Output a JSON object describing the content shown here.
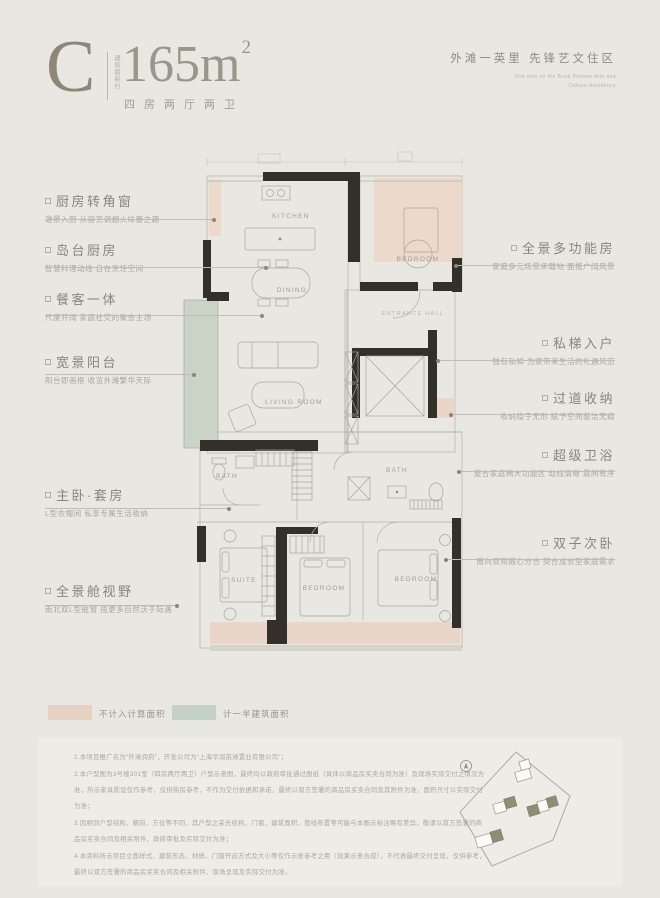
{
  "header": {
    "type_letter": "C",
    "area_label_vertical": "建筑面积约",
    "area_value": "165m",
    "area_sup": "2",
    "layout_text": "四房两厅两卫",
    "project_name": "外滩一英里  先锋艺文住区",
    "project_sub_en_1": "One mile on the Bund Pioneer Arts and",
    "project_sub_en_2": "Culture Residency"
  },
  "plan": {
    "rooms": {
      "kitchen": "KITCHEN",
      "dining": "DINING",
      "living": "LIVING ROOM",
      "bedroom_top": "BEDROOM",
      "entrance": "ENTRANCE HALL",
      "bath_left": "BATH",
      "bath_right": "BATH",
      "suite": "SUITE",
      "bedroom_mid": "BEDROOM",
      "bedroom_right": "BEDROOM"
    }
  },
  "callouts_left": [
    {
      "title": "厨房转角窗",
      "sub": "邀景入厨 从容烹调烟火味蕾之趣"
    },
    {
      "title": "岛台厨房",
      "sub": "智慧料理动线 自在烹饪空间"
    },
    {
      "title": "餐客一体",
      "sub": "尺度开阔 家庭社交的聚会主场"
    },
    {
      "title": "宽景阳台",
      "sub": "阳台即画框 收览外滩繁华天际"
    },
    {
      "title": "主卧·套房",
      "sub": "L型衣帽间 私享专属生活收纳"
    },
    {
      "title": "全景舱视野",
      "sub": "南北双L型舷窗 揽更多自然沃于际遇"
    }
  ],
  "callouts_right": [
    {
      "title": "全景多功能房",
      "sub": "家庭多元场景承载地 面揽广阔风景"
    },
    {
      "title": "私梯入户",
      "sub": "独有私梯 为家带来生活的礼遇风范"
    },
    {
      "title": "过道收纳",
      "sub": "收纳隐于无形 赋予空间整洁无痕"
    },
    {
      "title": "超级卫浴",
      "sub": "整合家庭两大功能区 动线清晰 晨间有序"
    },
    {
      "title": "双子次卧",
      "sub": "南向双阳随心分合 契合成长型家庭需求"
    }
  ],
  "legend": [
    {
      "label": "不计入计算面积",
      "color": "#e6d2c5"
    },
    {
      "label": "计一半建筑面积",
      "color": "#c6d1c5"
    }
  ],
  "disclaimer": {
    "items": [
      "1.本项目推广名为“外滩润府”，开发公司为“上海华润前滩置业有限公司”；",
      "2.本户型图为3号楼301室（四房两厅两卫）户型示意图，最终均以政府审批通过图纸（具体以商品房买卖合同为准）及现场实际交付之情况为准，所示家具陈设仅作参考，仅供购房参考，不作为交付依据和承诺，最终以双方签署的商品房买卖合同及其附件为准，面积尺寸以实际交付为准；",
      "3.因相邻户型结构、朝向、方位等不同，其户型之采光结构、门窗、建筑面积、管线布置等可能与本图示标注略有差异，敬请以双方签署的商品房买卖合同及相关附件、政府审批及实际交付为准；",
      "4.本资料所示项目立面样式、建筑形态、材质、门窗开启方式及大小等仅作示意参考之用（效果示意合成），不代表最终交付呈现，仅供参考，最终以双方签署的商品房买卖合同及相关附件、现场呈现及实际交付为准。"
    ]
  },
  "colors": {
    "not_counted_fill": "#ecd9cb",
    "half_counted_fill": "#c9d3c6",
    "wall": "#33302c",
    "accent_text": "#8b867a"
  }
}
